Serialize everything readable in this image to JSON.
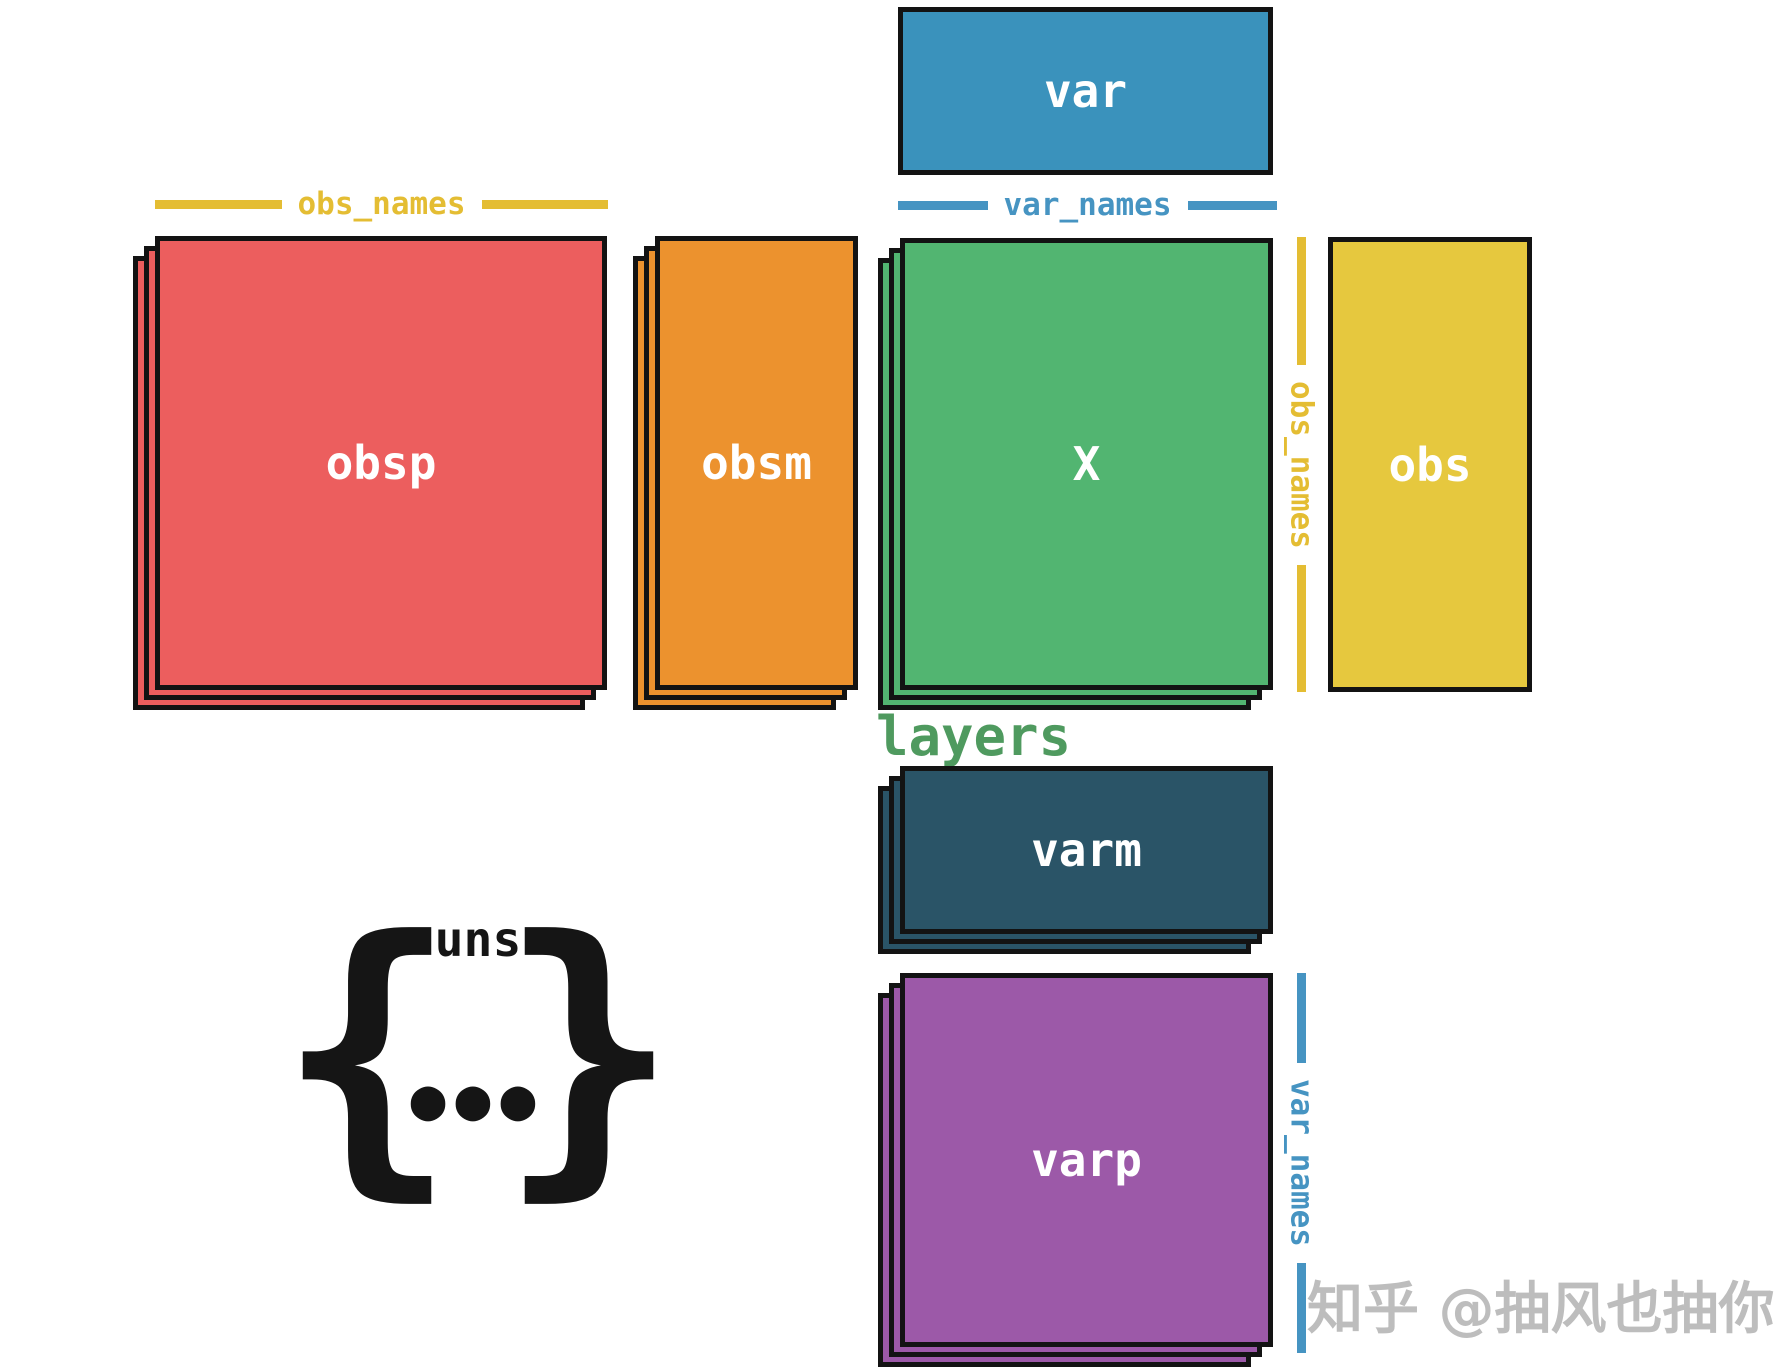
{
  "diagram": {
    "boxes": {
      "var": {
        "label": "var",
        "color": "#3a92bc"
      },
      "obsp": {
        "label": "obsp",
        "color": "#ec5e5e"
      },
      "obsm": {
        "label": "obsm",
        "color": "#ec922e"
      },
      "X": {
        "label": "X",
        "color": "#52b571"
      },
      "obs": {
        "label": "obs",
        "color": "#e6c83e"
      },
      "varm": {
        "label": "varm",
        "color": "#2a5467"
      },
      "varp": {
        "label": "varp",
        "color": "#9c59a8"
      }
    },
    "axis_labels": {
      "obs_names_top": {
        "text": "obs_names",
        "color": "#e4bd33"
      },
      "var_names_top": {
        "text": "var_names",
        "color": "#4694c2"
      },
      "obs_names_side": {
        "text": "obs_names",
        "color": "#e4bd33"
      },
      "var_names_side": {
        "text": "var_names",
        "color": "#4694c2"
      }
    },
    "layers_label": {
      "text": "layers",
      "color": "#4f9a5f"
    },
    "uns": {
      "label": "uns",
      "brace_left": "{",
      "brace_right": "}",
      "ellipsis": "●●●",
      "color": "#151515"
    }
  },
  "watermark": {
    "text": "知乎 @抽风也抽你",
    "color": "#bdbdbd"
  }
}
